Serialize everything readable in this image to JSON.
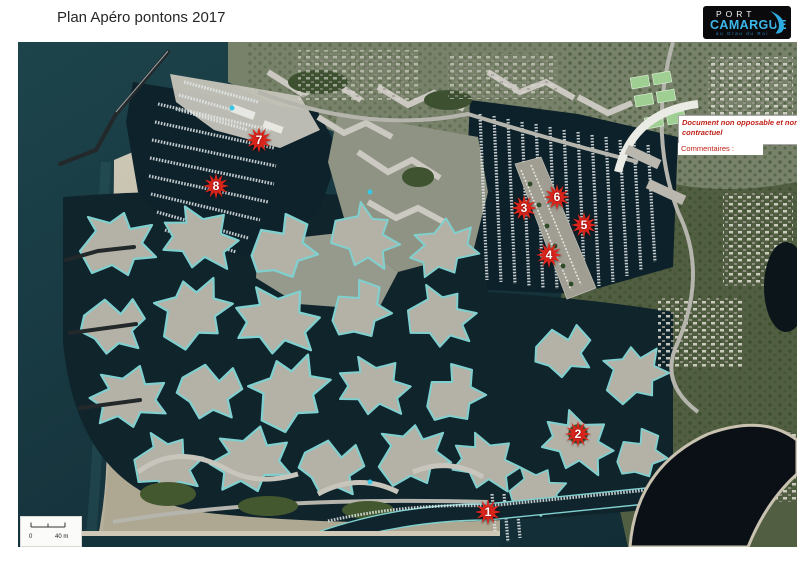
{
  "page": {
    "title": "Plan Apéro pontons 2017"
  },
  "logo": {
    "port": "PORT",
    "camargue": "CAMARGUE",
    "tagline": "au Grau du Roi"
  },
  "overlay": {
    "disclaimer": "Document non opposable et non contractuel",
    "comments_label": "Commentaires :"
  },
  "scale_bar": {
    "start_label": "0",
    "end_label": "40 m"
  },
  "markers": [
    {
      "label": "1"
    },
    {
      "label": "2"
    },
    {
      "label": "3"
    },
    {
      "label": "4"
    },
    {
      "label": "5"
    },
    {
      "label": "6"
    },
    {
      "label": "7"
    },
    {
      "label": "8"
    }
  ],
  "colors": {
    "marker_red": "#da251c",
    "quay_cyan": "#7fd0cf",
    "logo_cyan": "#3cb7ea",
    "disclaimer_red": "#c02018",
    "sea": "#16333b",
    "sand": "#c6c0af"
  }
}
